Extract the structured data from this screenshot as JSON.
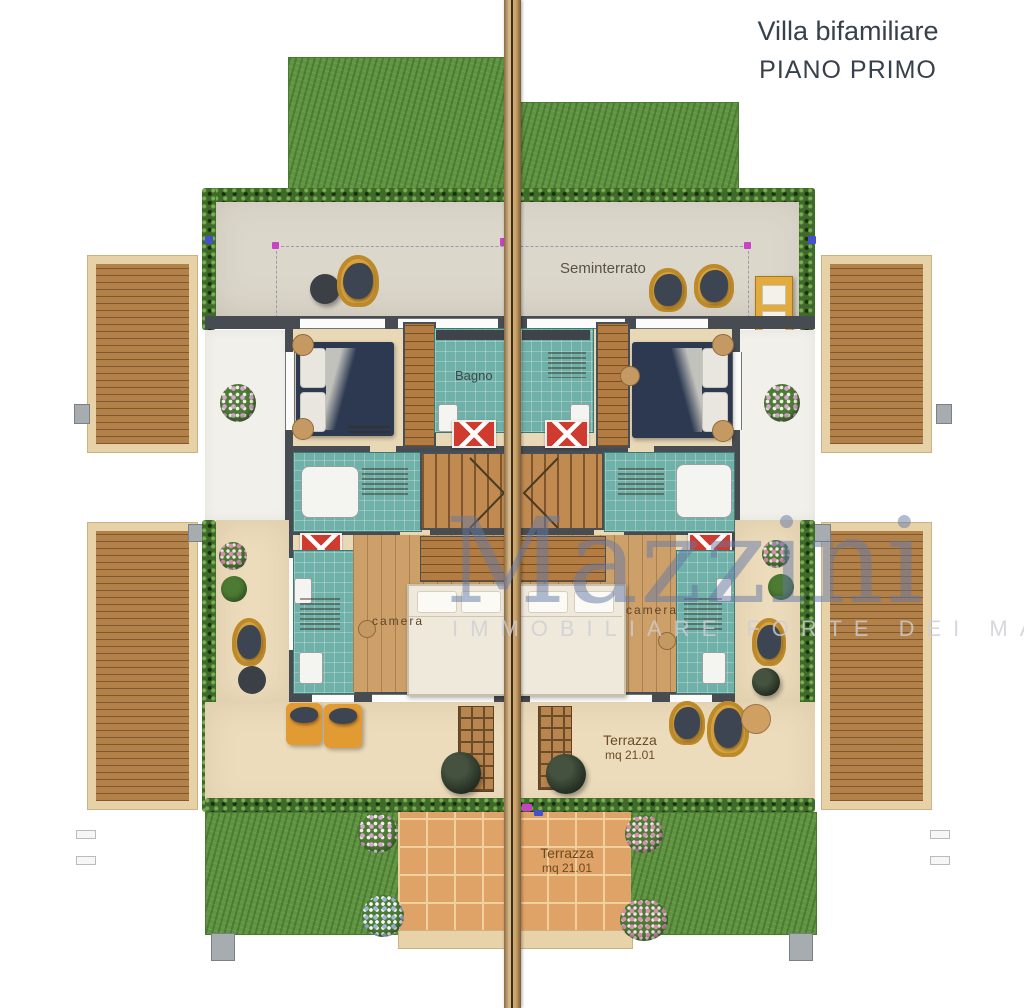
{
  "title": {
    "line1": "Villa bifamiliare",
    "line2": "PIANO PRIMO"
  },
  "plan": {
    "seminterrato_label": "Seminterrato",
    "bagno_label": "Bagno",
    "camera_left_label": "camera",
    "camera_right_label": "camera",
    "terrazza_upper": {
      "name": "Terrazza",
      "area": "mq 21.01"
    },
    "terrazza_lower": {
      "name": "Terrazza",
      "area": "mq 21.01"
    }
  },
  "watermark": {
    "brand": "Mazzini",
    "subtitle": "IMMOBILIARE FORTE DEI MARMI"
  },
  "palette": {
    "grass": "#5f9440",
    "hedge": "#3e6b2a",
    "concrete_roof": "#dcd7cb",
    "terrace_beige": "#ecdcbc",
    "teal_tile": "#6fb0a8",
    "wood_floor": "#cda06a",
    "wall": "#474c52",
    "bed_navy": "#2c3950",
    "wicker_yellow": "#d8a23d",
    "terracotta_tile": "#dfa267",
    "watermark_blue": "#6e7ea8",
    "title_text": "#37414b",
    "marker_magenta": "#c643c6",
    "marker_blue": "#4450cc",
    "rug_red": "#cf3b2e"
  }
}
